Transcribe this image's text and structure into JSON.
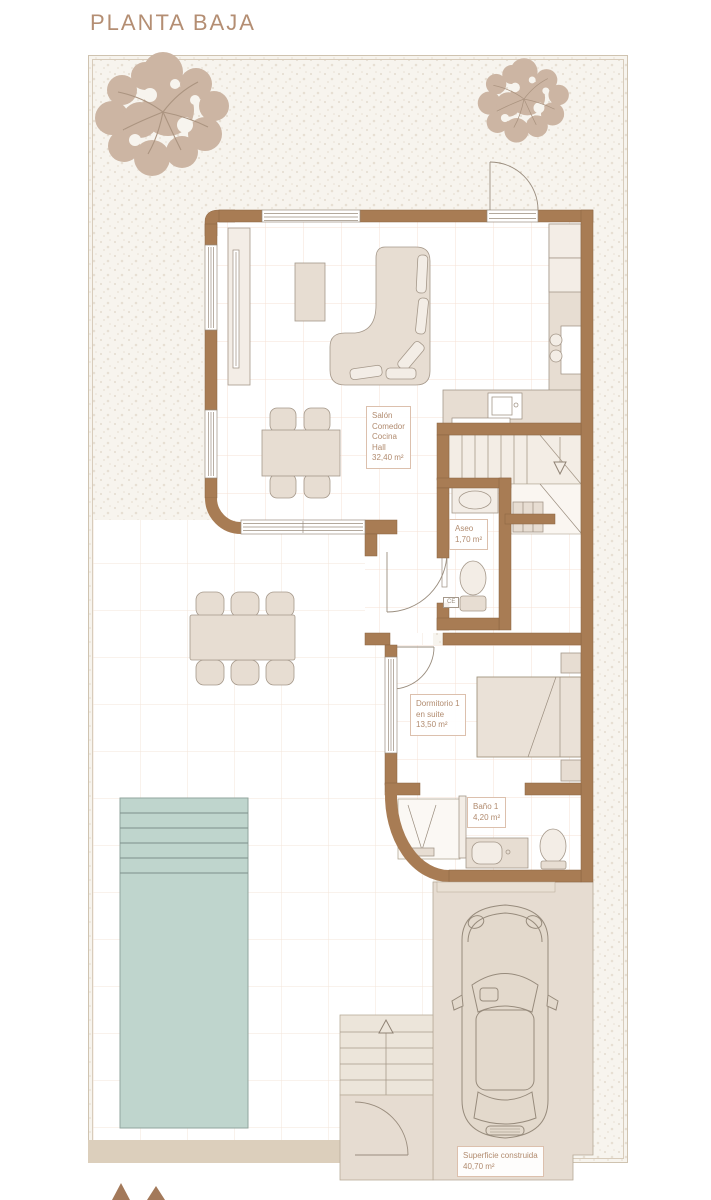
{
  "title": "PLANTA BAJA",
  "labels": {
    "salon": {
      "lines": [
        "Salón",
        "Comedor",
        "Cocina",
        "Hall",
        "32,40 m²"
      ]
    },
    "aseo": {
      "lines": [
        "Aseo",
        "1,70 m²"
      ]
    },
    "dormitorio": {
      "lines": [
        "Dormitorio 1",
        "en suite",
        "13,50 m²"
      ]
    },
    "bano": {
      "lines": [
        "Baño 1",
        "4,20 m²"
      ]
    },
    "superficie": {
      "lines": [
        "Superficie construida",
        "40,70 m²"
      ]
    },
    "ce": "CE"
  },
  "colors": {
    "title": "#b48e73",
    "label": "#b18b6f",
    "label_border": "#dcc0ad",
    "wall": "#a87c54",
    "wall_edge": "#8a6340",
    "furn": "#e7ddd2",
    "furn_light": "#f3ede6",
    "furn_edge": "#a5988a",
    "garden": "#f7f4ee",
    "speckle": "#e7dfd3",
    "terrace_grid": "#f3e4da",
    "floor_grid": "#f6e0d4",
    "pool": "#bfd5cd",
    "pool_line": "#7d908a",
    "drive": "#e6dcd1",
    "drive_edge": "#b5a896",
    "tree": "#ccb5a3",
    "branch": "#ab9480",
    "strip": "#dccfbc",
    "logo": "#a3795a"
  }
}
